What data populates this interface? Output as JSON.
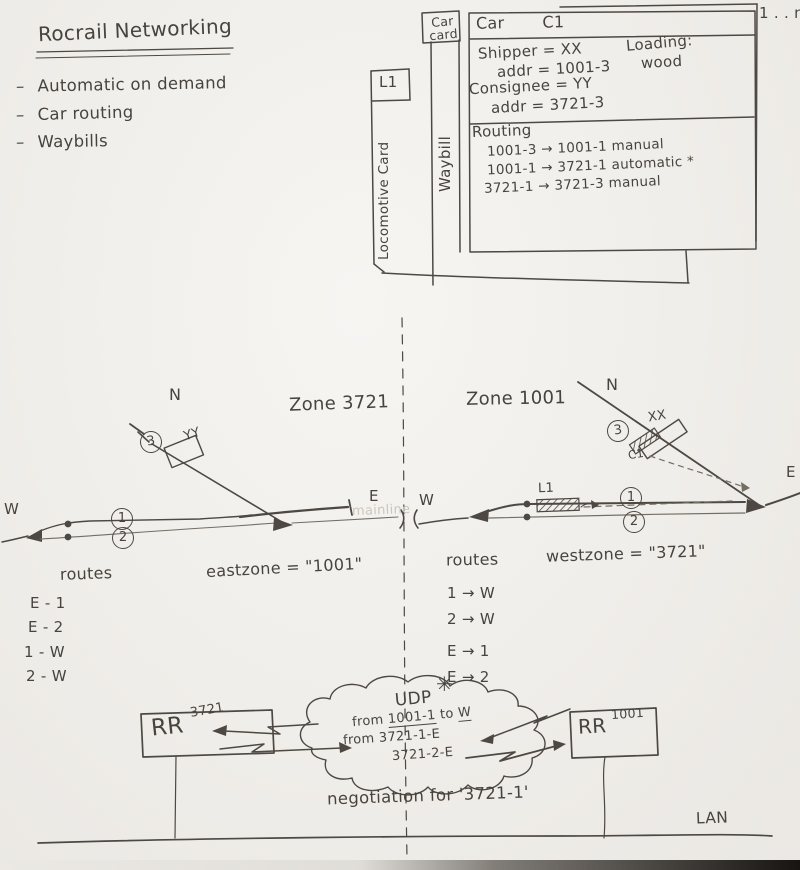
{
  "notes": {
    "title": "Rocrail Networking",
    "bullet_char": "–",
    "bullets": [
      "Automatic on demand",
      "Car routing",
      "Waybills"
    ]
  },
  "cards": {
    "stack_label": "1 . . n",
    "tab_line1": "Car",
    "tab_line2": "card",
    "waybill_label": "Waybill",
    "loco_header": "L1",
    "loco_label": "Locomotive Card",
    "car_type": "Car",
    "car_id": "C1",
    "shipper": "Shipper = XX",
    "shipper_addr": "addr = 1001-3",
    "loading_label": "Loading:",
    "loading_value": "wood",
    "consignee": "Consignee = YY",
    "consignee_addr": "addr = 3721-3",
    "routing_title": "Routing",
    "routing_lines": [
      "1001-3 → 1001-1   manual",
      "1001-1 → 3721-1   automatic *",
      "3721-1 → 3721-3   manual"
    ]
  },
  "trackplan": {
    "west_zone": {
      "title": "Zone 3721",
      "compass": "N",
      "end_west": "W",
      "end_east": "E",
      "track1": "1",
      "track2": "2",
      "siding": "3",
      "building": "YY"
    },
    "east_zone": {
      "title": "Zone 1001",
      "compass": "N",
      "end_west": "W",
      "end_east": "E",
      "track1": "1",
      "track2": "2",
      "siding": "3",
      "building": "XX",
      "car": "C1",
      "loco": "L1"
    },
    "faint_label": "mainline"
  },
  "routes_tables": {
    "west": {
      "title": "routes",
      "zone": "eastzone = \"1001\"",
      "entries": [
        "E - 1",
        "E - 2",
        "1 - W",
        "2 - W"
      ]
    },
    "east": {
      "title": "routes",
      "zone": "westzone = \"3721\"",
      "entries": [
        "1 → W",
        "2 → W",
        "E → 1",
        "E → 2"
      ]
    }
  },
  "network": {
    "left_node": {
      "name": "RR",
      "zone": "3721"
    },
    "right_node": {
      "name": "RR",
      "zone": "1001"
    },
    "asterisk": "✳",
    "cloud": {
      "protocol": "UDP",
      "msg1_prefix": "from ",
      "msg1_from": "1001-1",
      "msg1_mid": " to ",
      "msg1_dest": "W",
      "msg2": "from 3721-1-E",
      "ms3_spacer": "",
      "msg3": "3721-2-E"
    },
    "caption": "negotiation for '3721-1'",
    "lan_label": "LAN"
  }
}
